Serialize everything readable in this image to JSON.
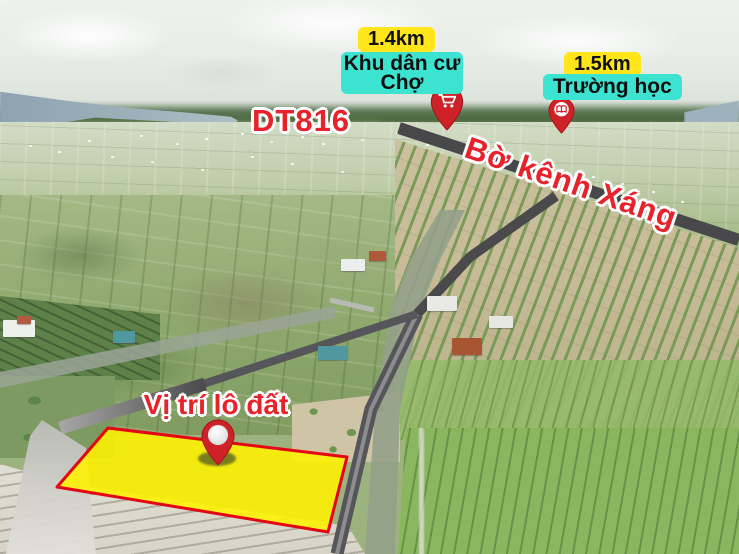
{
  "page": {
    "kind": "real-estate-aerial-location-map"
  },
  "colors": {
    "badge_yellow": "#ffe51a",
    "badge_cyan": "#3be3d0",
    "marker_red": "#cf2128",
    "label_red": "#e8222a",
    "plot_fill": "#fff200",
    "plot_border": "#e30613",
    "road_overlay": "#48484b"
  },
  "markers": {
    "market": {
      "distance": "1.4km",
      "name": "Khu dân cư Chợ",
      "icon": "cart-icon"
    },
    "school": {
      "distance": "1.5km",
      "name": "Trường học",
      "icon": "book-icon"
    },
    "plot": {
      "label": "Vị trí lô đất",
      "icon": "location-pin-icon"
    }
  },
  "roads": {
    "highway_label": "DT816",
    "canal_road_label": "Bờ kênh Xáng"
  }
}
